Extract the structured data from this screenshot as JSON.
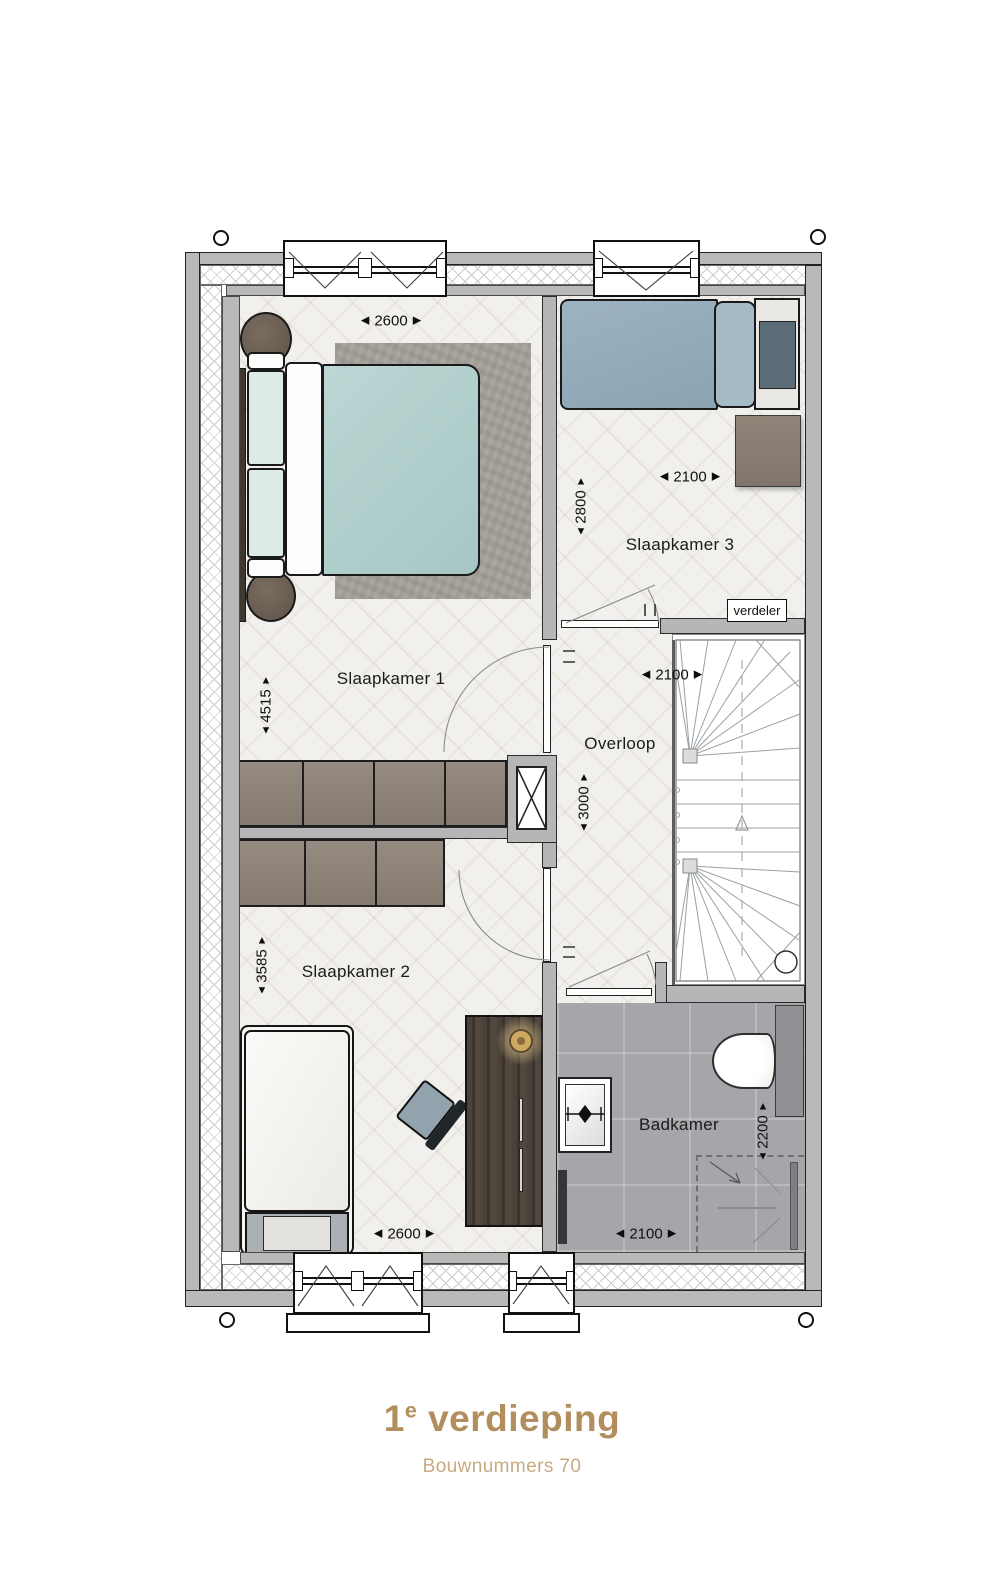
{
  "title": {
    "number": "1",
    "sup": "e",
    "word": "verdieping",
    "subtitle": "Bouwnummers 70"
  },
  "rooms": [
    {
      "name": "Slaapkamer 1"
    },
    {
      "name": "Slaapkamer 3"
    },
    {
      "name": "Overloop"
    },
    {
      "name": "Slaapkamer 2"
    },
    {
      "name": "Badkamer"
    }
  ],
  "dimensions": [
    {
      "value": "2600",
      "orientation": "horizontal",
      "location": "slaapkamer-1-top"
    },
    {
      "value": "2800",
      "orientation": "vertical",
      "location": "slaapkamer-3"
    },
    {
      "value": "2100",
      "orientation": "horizontal",
      "location": "slaapkamer-3"
    },
    {
      "value": "4515",
      "orientation": "vertical",
      "location": "slaapkamer-1"
    },
    {
      "value": "2100",
      "orientation": "horizontal",
      "location": "overloop-trap"
    },
    {
      "value": "3000",
      "orientation": "vertical",
      "location": "overloop"
    },
    {
      "value": "3585",
      "orientation": "vertical",
      "location": "slaapkamer-2"
    },
    {
      "value": "2200",
      "orientation": "vertical",
      "location": "badkamer"
    },
    {
      "value": "2600",
      "orientation": "horizontal",
      "location": "slaapkamer-2-bottom"
    },
    {
      "value": "2100",
      "orientation": "horizontal",
      "location": "badkamer-bottom"
    }
  ],
  "annotations": {
    "verdeler": "verdeler"
  },
  "arrows": {
    "left": "◀",
    "right": "▶",
    "up": "▲",
    "down": "▼"
  },
  "corner_markers": {
    "shape": "circle",
    "count": 4
  },
  "colors": {
    "title": "#b18e5c",
    "subtitle": "#c9a982",
    "wall": "#b6b6b6",
    "bathroom_floor": "#a6a6aa",
    "bed_teal": "#b6d1cf",
    "bed_blue": "#90a9b8",
    "closet_wood": "#8d8177"
  }
}
